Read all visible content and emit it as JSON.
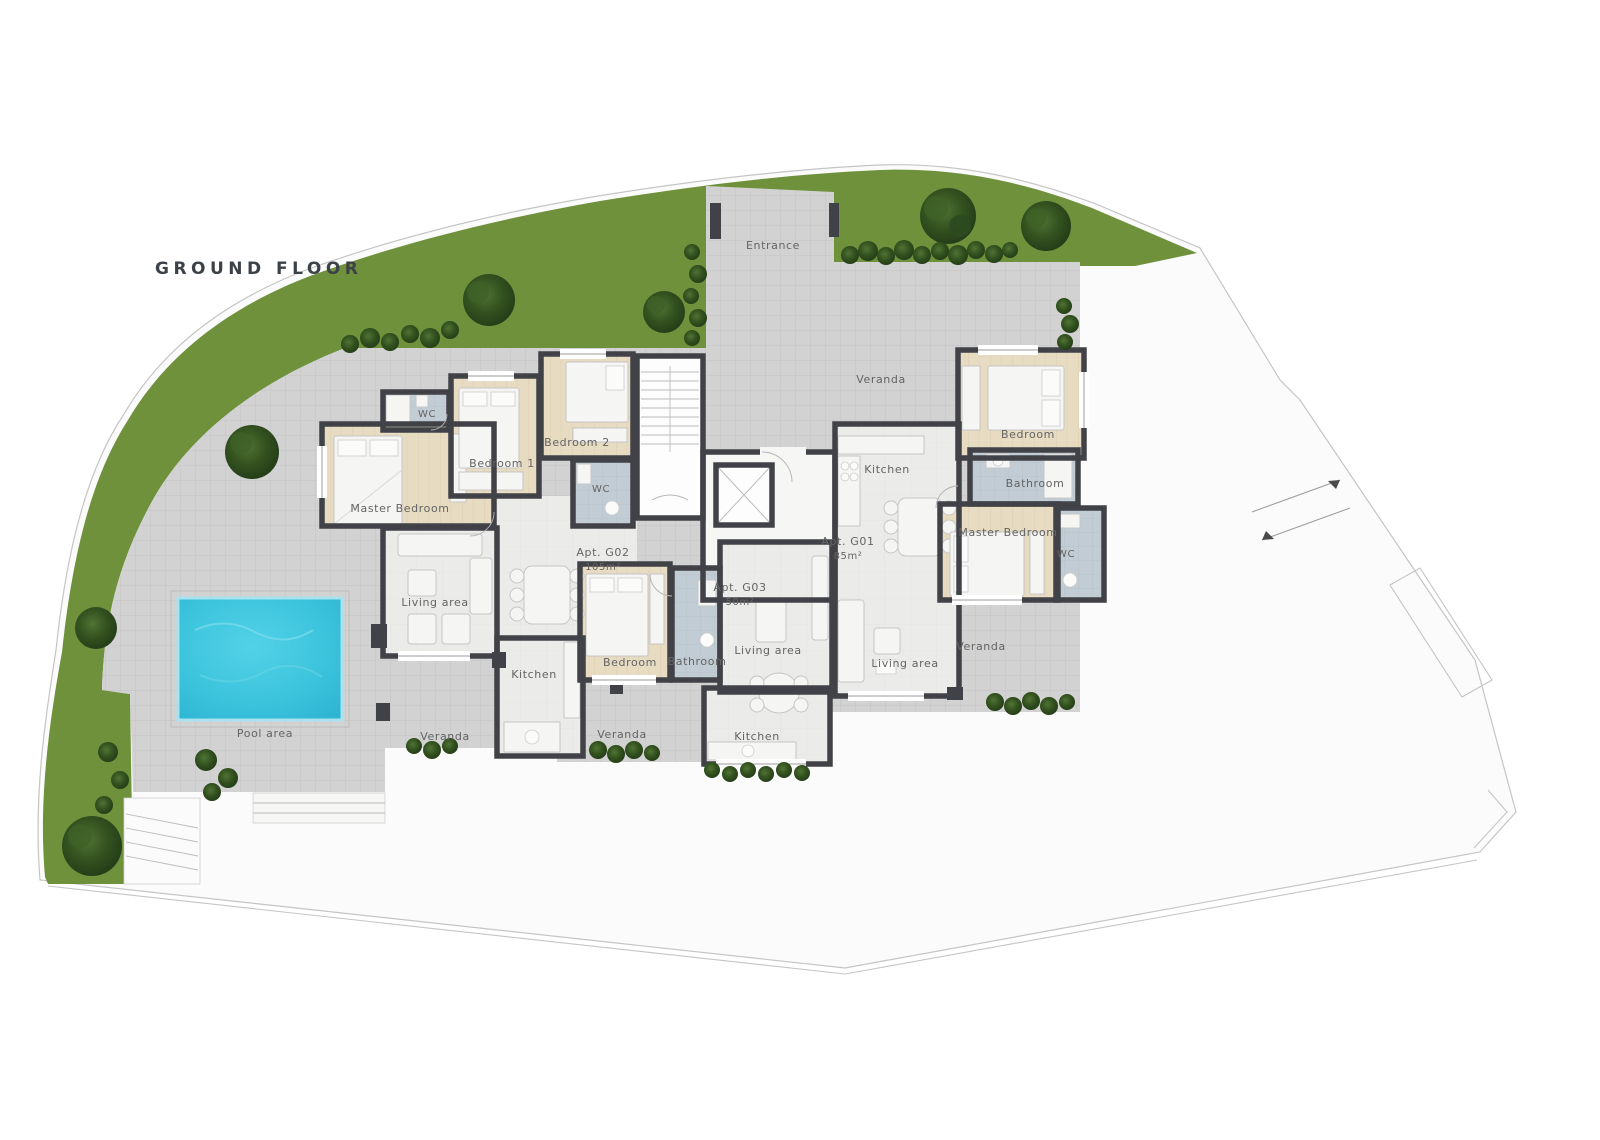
{
  "title": "GROUND FLOOR",
  "labels": {
    "entrance": "Entrance",
    "veranda_top": "Veranda",
    "veranda_left": "Veranda",
    "veranda_center": "Veranda",
    "veranda_right": "Veranda",
    "pool": "Pool area",
    "g02": {
      "id": "Apt. G02",
      "area": "105m²",
      "master": "Master Bedroom",
      "bedroom1": "Bedroom 1",
      "bedroom2": "Bedroom 2",
      "wc1": "WC",
      "wc2": "WC",
      "living": "Living area",
      "kitchen": "Kitchen"
    },
    "g03": {
      "id": "Apt. G03",
      "area": "50m²",
      "bedroom": "Bedroom",
      "bathroom": "Bathroom",
      "living": "Living area",
      "kitchen": "Kitchen"
    },
    "g01": {
      "id": "Apt. G01",
      "area": "85m²",
      "kitchen": "Kitchen",
      "bedroom": "Bedroom",
      "bathroom": "Bathroom",
      "master": "Master Bedroom",
      "wc": "WC",
      "living": "Living area"
    }
  },
  "colors": {
    "grass": "#6f913c",
    "paving": "#d2d2d3",
    "paving_grid": "#c4c4c6",
    "wall": "#414247",
    "wood_floor": "#e7dbc2",
    "tile_floor": "#ebebe9",
    "bath_floor": "#c1ccd5",
    "pool_water": "#3cc4dd",
    "label_text": "#646464",
    "title_text": "#3c4248"
  }
}
